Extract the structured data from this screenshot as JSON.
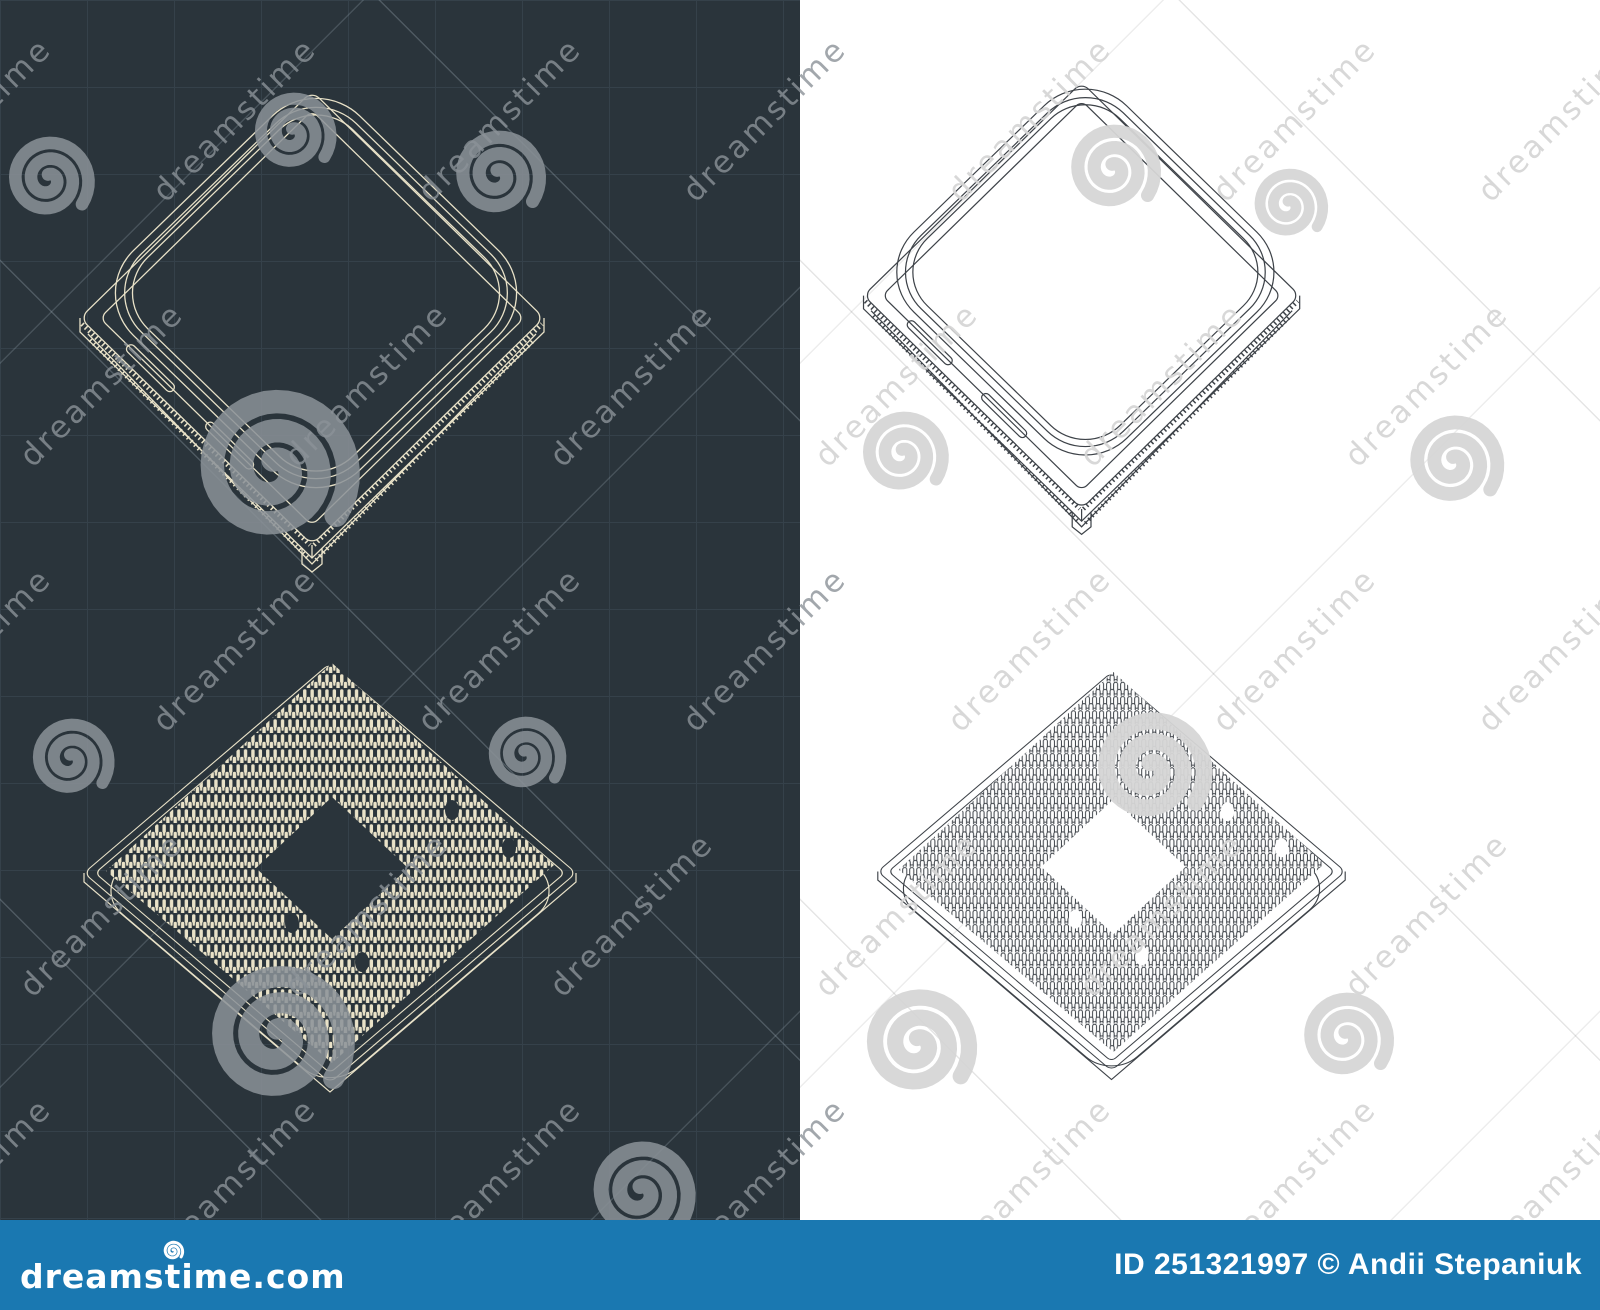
{
  "meta": {
    "kind": "stock-image-preview",
    "subject": "Isometric blueprints of a CPU (top view and bottom pin-side view), drawn on a dark blueprint panel and a white panel"
  },
  "colors": {
    "dark_bg": "#2a343b",
    "grid": "#35414a",
    "cream": "#e9e2c8",
    "ink": "#3d4248",
    "light_bg": "#ffffff",
    "wm_dark": "#8b9298",
    "wm_light": "#d6d6d6",
    "footer_bg": "#1a78b1"
  },
  "figures": [
    {
      "name": "cpu-top-view-dark",
      "panel": "dark",
      "view": "isometric top view with heat spreader"
    },
    {
      "name": "cpu-top-view-light",
      "panel": "light",
      "view": "isometric top view with heat spreader"
    },
    {
      "name": "cpu-bottom-view-dark",
      "panel": "dark",
      "view": "isometric bottom view with pin grid array"
    },
    {
      "name": "cpu-bottom-view-light",
      "panel": "light",
      "view": "isometric bottom view with pin grid array"
    }
  ],
  "watermark": {
    "text": "dreamstime",
    "spirals": [
      {
        "x": 48,
        "y": 182,
        "r": 42
      },
      {
        "x": 292,
        "y": 136,
        "r": 40
      },
      {
        "x": 497,
        "y": 178,
        "r": 44
      },
      {
        "x": 273,
        "y": 472,
        "r": 78
      },
      {
        "x": 70,
        "y": 762,
        "r": 40
      },
      {
        "x": 524,
        "y": 758,
        "r": 38
      },
      {
        "x": 277,
        "y": 1040,
        "r": 70
      },
      {
        "x": 640,
        "y": 1195,
        "r": 50
      },
      {
        "x": 1112,
        "y": 172,
        "r": 44
      },
      {
        "x": 1288,
        "y": 208,
        "r": 36
      },
      {
        "x": 1453,
        "y": 465,
        "r": 46
      },
      {
        "x": 902,
        "y": 457,
        "r": 42
      },
      {
        "x": 1150,
        "y": 772,
        "r": 56
      },
      {
        "x": 917,
        "y": 1047,
        "r": 54
      },
      {
        "x": 1345,
        "y": 1040,
        "r": 44
      }
    ]
  },
  "footer": {
    "logo_text": "dreamstime.com",
    "credit": "ID 251321997 © Andii Stepaniuk"
  }
}
